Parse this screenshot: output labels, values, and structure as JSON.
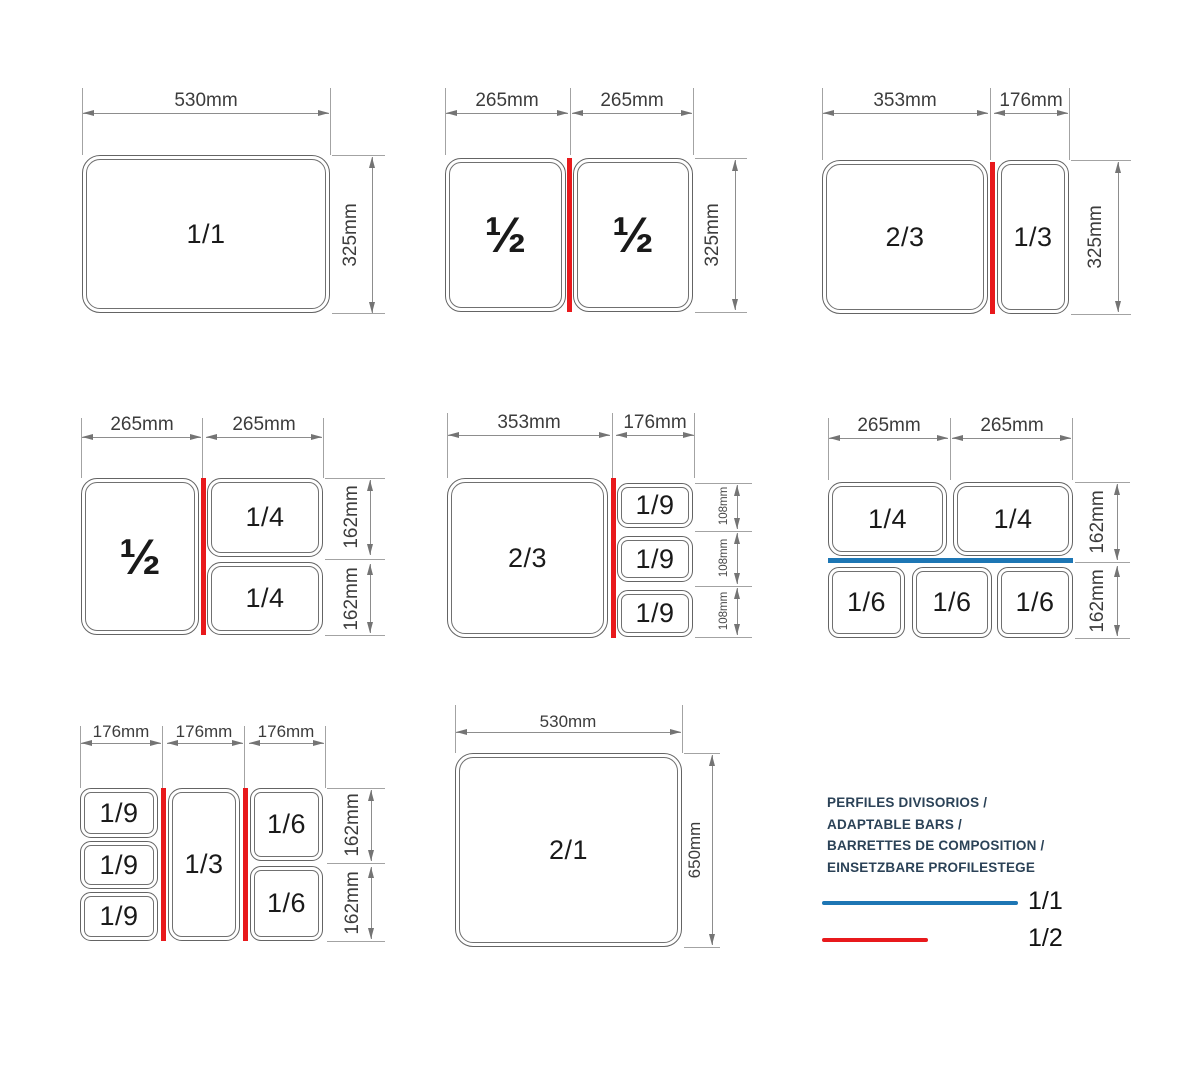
{
  "colors": {
    "bar_full": "#1d76b4",
    "bar_half": "#e8191c",
    "dimension_line": "#8d8d8d",
    "legend_text": "#2b4257"
  },
  "diagrams": [
    {
      "widths": [
        "530mm"
      ],
      "heights": [
        "325mm"
      ],
      "pans": [
        "1/1"
      ]
    },
    {
      "widths": [
        "265mm",
        "265mm"
      ],
      "heights": [
        "325mm"
      ],
      "pans": [
        "½",
        "½"
      ]
    },
    {
      "widths": [
        "353mm",
        "176mm"
      ],
      "heights": [
        "325mm"
      ],
      "pans": [
        "2/3",
        "1/3"
      ]
    },
    {
      "widths": [
        "265mm",
        "265mm"
      ],
      "heights": [
        "162mm",
        "162mm"
      ],
      "pans": [
        "½",
        "1/4",
        "1/4"
      ]
    },
    {
      "widths": [
        "353mm",
        "176mm"
      ],
      "heights": [
        "108mm",
        "108mm",
        "108mm"
      ],
      "pans": [
        "2/3",
        "1/9",
        "1/9",
        "1/9"
      ]
    },
    {
      "widths": [
        "265mm",
        "265mm"
      ],
      "heights": [
        "162mm",
        "162mm"
      ],
      "pans": [
        "1/4",
        "1/4",
        "1/6",
        "1/6",
        "1/6"
      ]
    },
    {
      "widths": [
        "176mm",
        "176mm",
        "176mm"
      ],
      "heights": [
        "162mm",
        "162mm"
      ],
      "pans": [
        "1/9",
        "1/9",
        "1/9",
        "1/3",
        "1/6",
        "1/6"
      ]
    },
    {
      "widths": [
        "530mm"
      ],
      "heights": [
        "650mm"
      ],
      "pans": [
        "2/1"
      ]
    }
  ],
  "legend": {
    "title_lines": [
      "PERFILES DIVISORIOS /",
      "ADAPTABLE BARS /",
      "BARRETTES DE COMPOSITION /",
      "EINSETZBARE PROFILESTEGE"
    ],
    "items": [
      {
        "label": "1/1",
        "color": "#1d76b4"
      },
      {
        "label": "1/2",
        "color": "#e8191c"
      }
    ]
  }
}
